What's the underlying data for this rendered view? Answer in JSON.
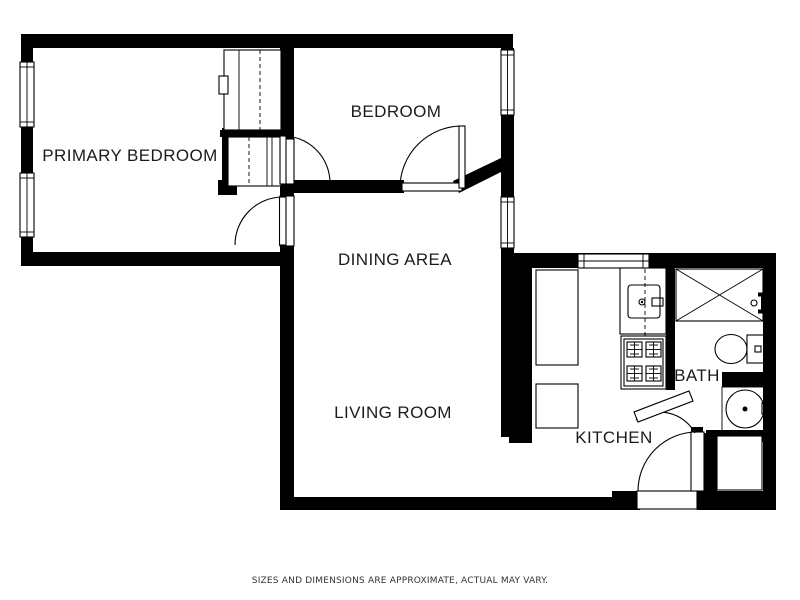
{
  "document": {
    "type": "floor-plan",
    "background_color": "#ffffff",
    "wall_color": "#000000",
    "label_color": "#1b1b1b",
    "disclaimer_color": "#333333"
  },
  "rooms": {
    "primary_bedroom": "PRIMARY BEDROOM",
    "bedroom": "BEDROOM",
    "dining": "DINING AREA",
    "living": "LIVING ROOM",
    "kitchen": "KITCHEN",
    "bath": "BATH"
  },
  "disclaimer": "SIZES AND DIMENSIONS ARE APPROXIMATE, ACTUAL MAY VARY.",
  "fixtures": [
    "window",
    "door",
    "closet",
    "kitchen-counter",
    "kitchen-sink",
    "stove",
    "shower",
    "toilet",
    "pedestal-sink",
    "entry-closet"
  ]
}
